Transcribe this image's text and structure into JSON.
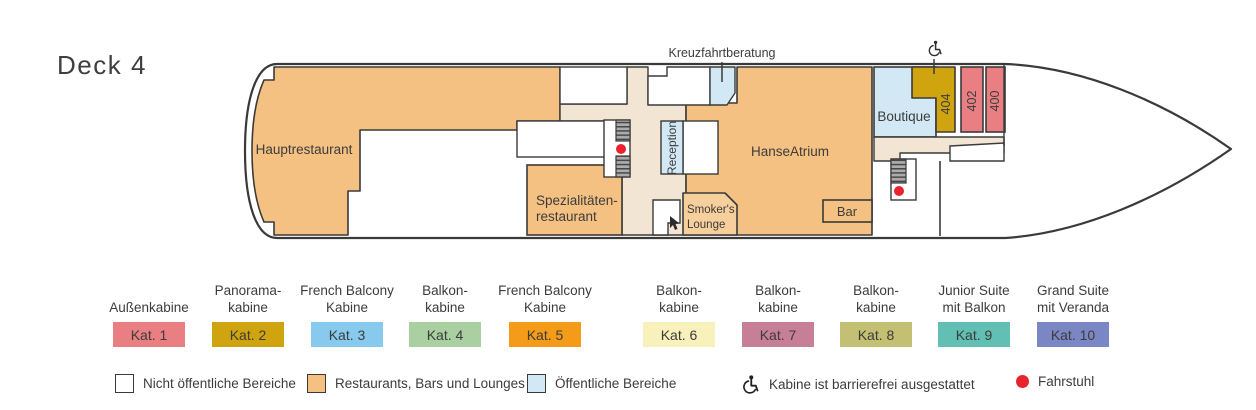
{
  "plan": {
    "deck_title": "Deck 4",
    "rooms": {
      "hauptrestaurant": "Hauptrestaurant",
      "spezialitaeten_line1": "Spezialitäten-",
      "spezialitaeten_line2": "restaurant",
      "reception": "Reception",
      "hanse_atrium": "HanseAtrium",
      "smokers_line1": "Smoker's",
      "smokers_line2": "Lounge",
      "bar": "Bar",
      "boutique": "Boutique",
      "kreuzfahrtberatung": "Kreuzfahrtberatung"
    },
    "cabins": [
      {
        "number": "404"
      },
      {
        "number": "402"
      },
      {
        "number": "400"
      }
    ]
  },
  "colors": {
    "wall": "#3A3A39",
    "text": "#3C3C3B",
    "restaurant": "#F4C183",
    "lounge": "#F7CF9C",
    "corridor": "#F3E5D4",
    "public": "#D2E8F4",
    "cabin_number_red": "#8E3338",
    "elevator": "#E8232E",
    "stairs_fill": "#ACACAC",
    "stairs_line": "#474747"
  },
  "legend": {
    "categories": [
      {
        "name": "Außenkabine",
        "label": "Kat. 1",
        "color": "#E97F82"
      },
      {
        "name": "Panorama-\nkabine",
        "label": "Kat. 2",
        "color": "#D0A40E"
      },
      {
        "name": "French Balcony\nKabine",
        "label": "Kat. 3",
        "color": "#87CAED"
      },
      {
        "name": "Balkon-\nkabine",
        "label": "Kat. 4",
        "color": "#AACFA0"
      },
      {
        "name": "French Balcony\nKabine",
        "label": "Kat. 5",
        "color": "#F49C1A"
      },
      {
        "name": "Balkon-\nkabine",
        "label": "Kat. 6",
        "color": "#F8F1BB"
      },
      {
        "name": "Balkon-\nkabine",
        "label": "Kat. 7",
        "color": "#C77F97"
      },
      {
        "name": "Balkon-\nkabine",
        "label": "Kat. 8",
        "color": "#C4C073"
      },
      {
        "name": "Junior Suite\nmit Balkon",
        "label": "Kat. 9",
        "color": "#62BFB3"
      },
      {
        "name": "Grand Suite\nmit Veranda",
        "label": "Kat. 10",
        "color": "#7B86C4"
      }
    ],
    "areas": [
      {
        "label": "Nicht öffentliche Bereiche",
        "color": "#FFFFFF"
      },
      {
        "label": "Restaurants, Bars und Lounges",
        "color": "#F4C183"
      },
      {
        "label": "Öffentliche Bereiche",
        "color": "#D2E8F4"
      }
    ],
    "accessible_label": "Kabine ist barrierefrei ausgestattet",
    "elevator_label": "Fahrstuhl"
  }
}
